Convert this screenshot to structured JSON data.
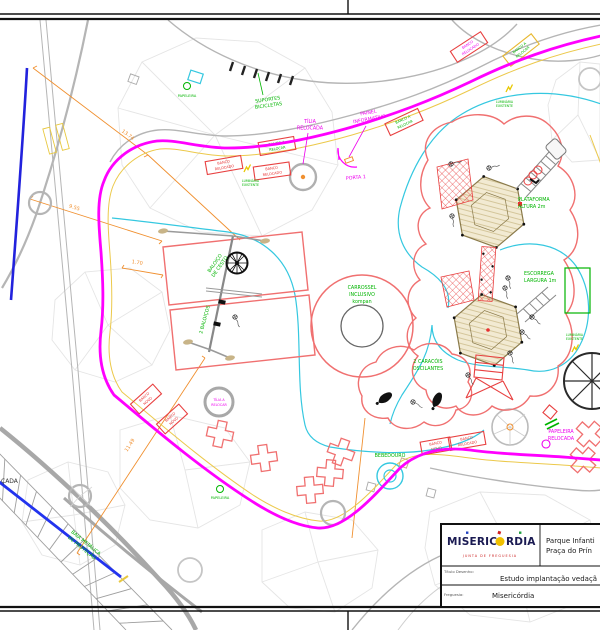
{
  "title_block": {
    "org_name": "MISERICÓRDIA",
    "org_subtitle": "JUNTA DE FREGUESIA",
    "project_line1": "Parque Infanti",
    "project_line2": "Praça do Prín",
    "drawing_title_label": "Título Desenho:",
    "drawing_title": "Estudo implantação vedaçã",
    "parish_label": "Freguesia:",
    "parish_value": "Misericórdia"
  },
  "labels": {
    "papeleira": "PAPELEIRA",
    "suportes_bicicletas": [
      "SUPORTES",
      "BICICLETAS"
    ],
    "tilia_relocada": [
      "TÍLIA",
      "RELOCADA"
    ],
    "painel_informativo": [
      "PAINEL",
      "INFORMATIVO"
    ],
    "porta_1": "PORTA 1",
    "banco_relocado": [
      "BANCO",
      "RELOCADO"
    ],
    "banco_a_relocar": [
      "BANCO A",
      "RELOCAR"
    ],
    "banco_novo": [
      "BANCO",
      "NOVO"
    ],
    "plataforma": [
      "PLATAFORMA",
      "ALTURA  2m"
    ],
    "escorrega": [
      "ESCORREGA",
      "LARGURA  1m"
    ],
    "carrossel": [
      "CARROSSEL",
      "INCLUSIVO",
      "kompan"
    ],
    "caracois": [
      "2  CARACÓIS",
      "OSCILANTES"
    ],
    "dois_baloicos": "2  BALOIÇOS",
    "baloico_cesto": [
      "BALOIÇO",
      "DE CESTO"
    ],
    "bebedouro": "BEBEDOURO",
    "papeleira_relocada": [
      "PAPELEIRA",
      "RELOCADA"
    ],
    "tilia_a_relocar": [
      "TÍLIA A",
      "RELOCAR"
    ],
    "luminaria_existente": [
      "LUMINÁRIA",
      "EXISTENTE"
    ],
    "baia_metalica": [
      "BAIA  METÁLICA",
      "DE  PROTEÇÃO"
    ],
    "calcada_partial": "ÇADA"
  },
  "dimensions": {
    "top_left": "13.74",
    "left_upper": "9.55",
    "left_small": "1.70",
    "lower_left": "11.49"
  },
  "colors": {
    "fence_magenta": "#ff00ff",
    "proposed_red": "#f07070",
    "equipment_green": "#00b400",
    "dimension_orange": "#f09030",
    "surface_cyan": "#35c8e0",
    "protection_blue": "#2222dd"
  }
}
